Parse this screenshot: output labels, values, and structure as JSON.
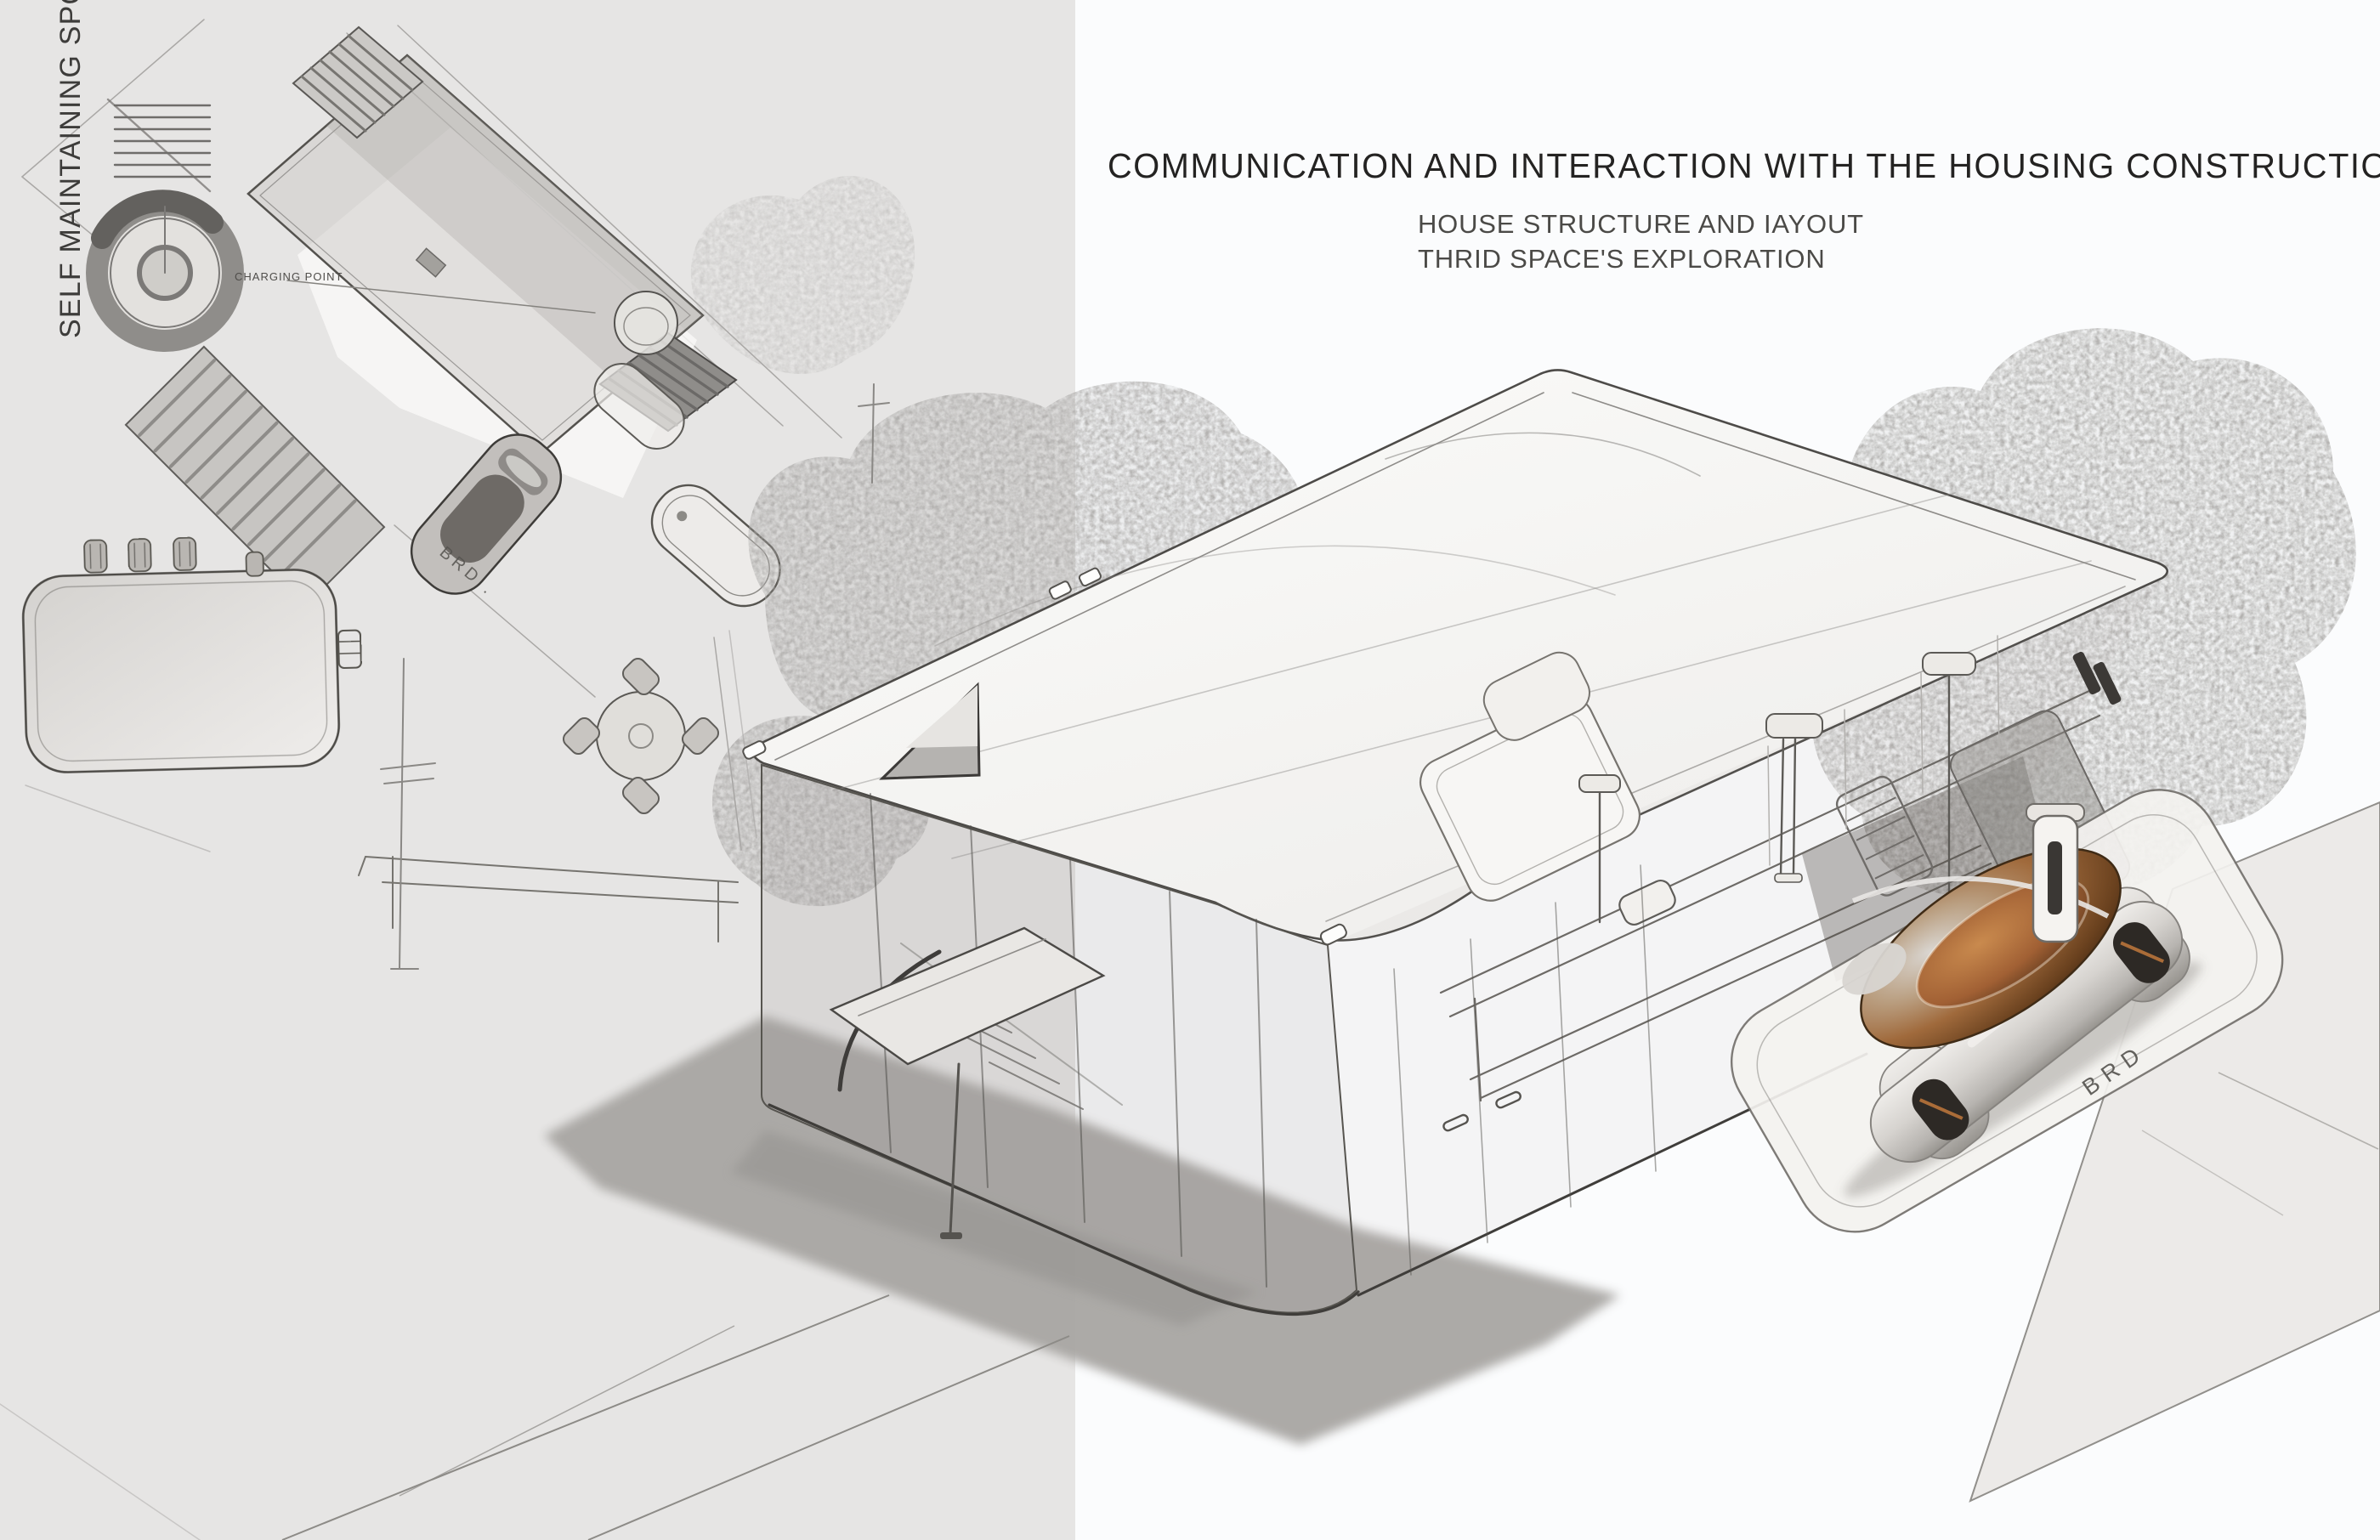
{
  "board": {
    "title": "COMMUNICATION AND INTERACTION WITH THE HOUSING CONSTRUCTION",
    "subtitle_lines": [
      "HOUSE STRUCTURE AND IAYOUT",
      "THRID SPACE'S EXPLORATION"
    ],
    "side_label": "SELF MAINTAINING SPOT"
  },
  "plan_view": {
    "charging_point_label": "CHARGING POINT",
    "handwritten_note": "BRD ."
  },
  "perspective_view": {
    "handwritten_note": "BRD"
  },
  "palette": {
    "panel_gray": "#e6e5e4",
    "paper_white": "#fbfcfd",
    "pencil": "#4f4d4a",
    "pencil_faint": "#8e8c89",
    "shadow_gray": "#a8a6a3",
    "ground_plane_gray": "#eceae8",
    "vehicle_body_silver": "#d9d6d2",
    "vehicle_canopy_bronze": "#a06a3c",
    "vehicle_canopy_deep": "#5f3a1e"
  }
}
